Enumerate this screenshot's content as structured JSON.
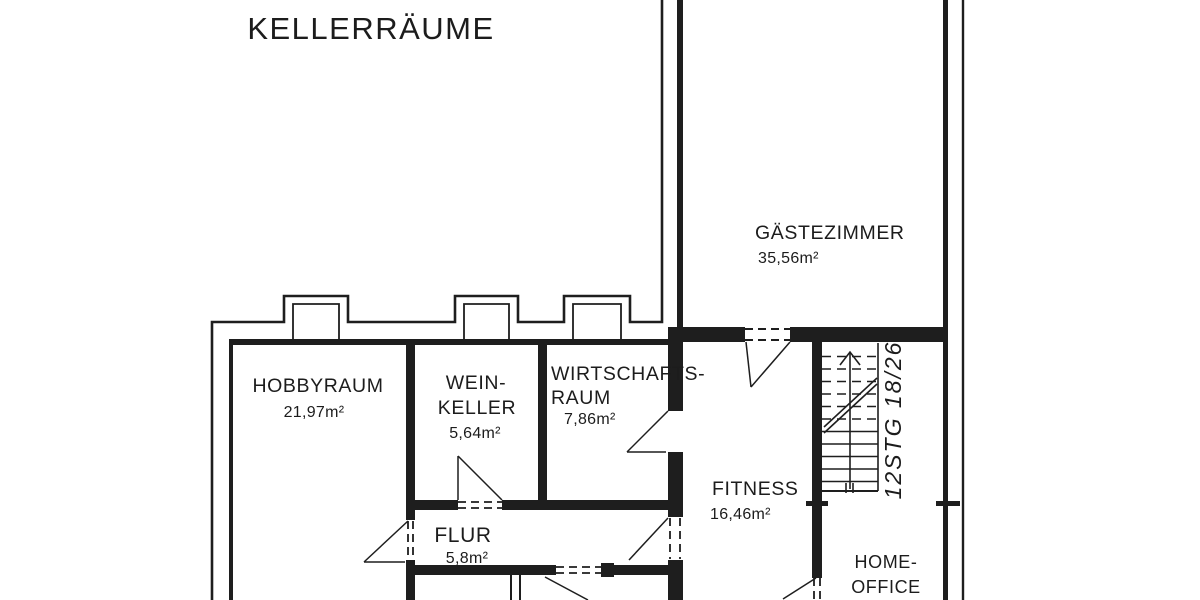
{
  "title": "KELLERRÄUME",
  "rooms": {
    "hobbyraum": {
      "name": "HOBBYRAUM",
      "area": "21,97m²"
    },
    "weinkeller": {
      "line1": "WEIN-",
      "line2": "KELLER",
      "area": "5,64m²"
    },
    "wirtschaftsraum": {
      "line1": "WIRTSCHAFTS-",
      "line2": "RAUM",
      "area": "7,86m²"
    },
    "gaestezimmer": {
      "name": "GÄSTEZIMMER",
      "area": "35,56m²"
    },
    "fitness": {
      "name": "FITNESS",
      "area": "16,46m²"
    },
    "flur": {
      "name": "FLUR",
      "area": "5,8m²"
    },
    "homeoffice": {
      "line1": "HOME-",
      "line2": "OFFICE"
    }
  },
  "stairs": {
    "label": "12STG 18/26",
    "step_count": 12
  },
  "colors": {
    "line": "#1e1e1e",
    "background": "#ffffff",
    "text": "#1c1c1c"
  }
}
